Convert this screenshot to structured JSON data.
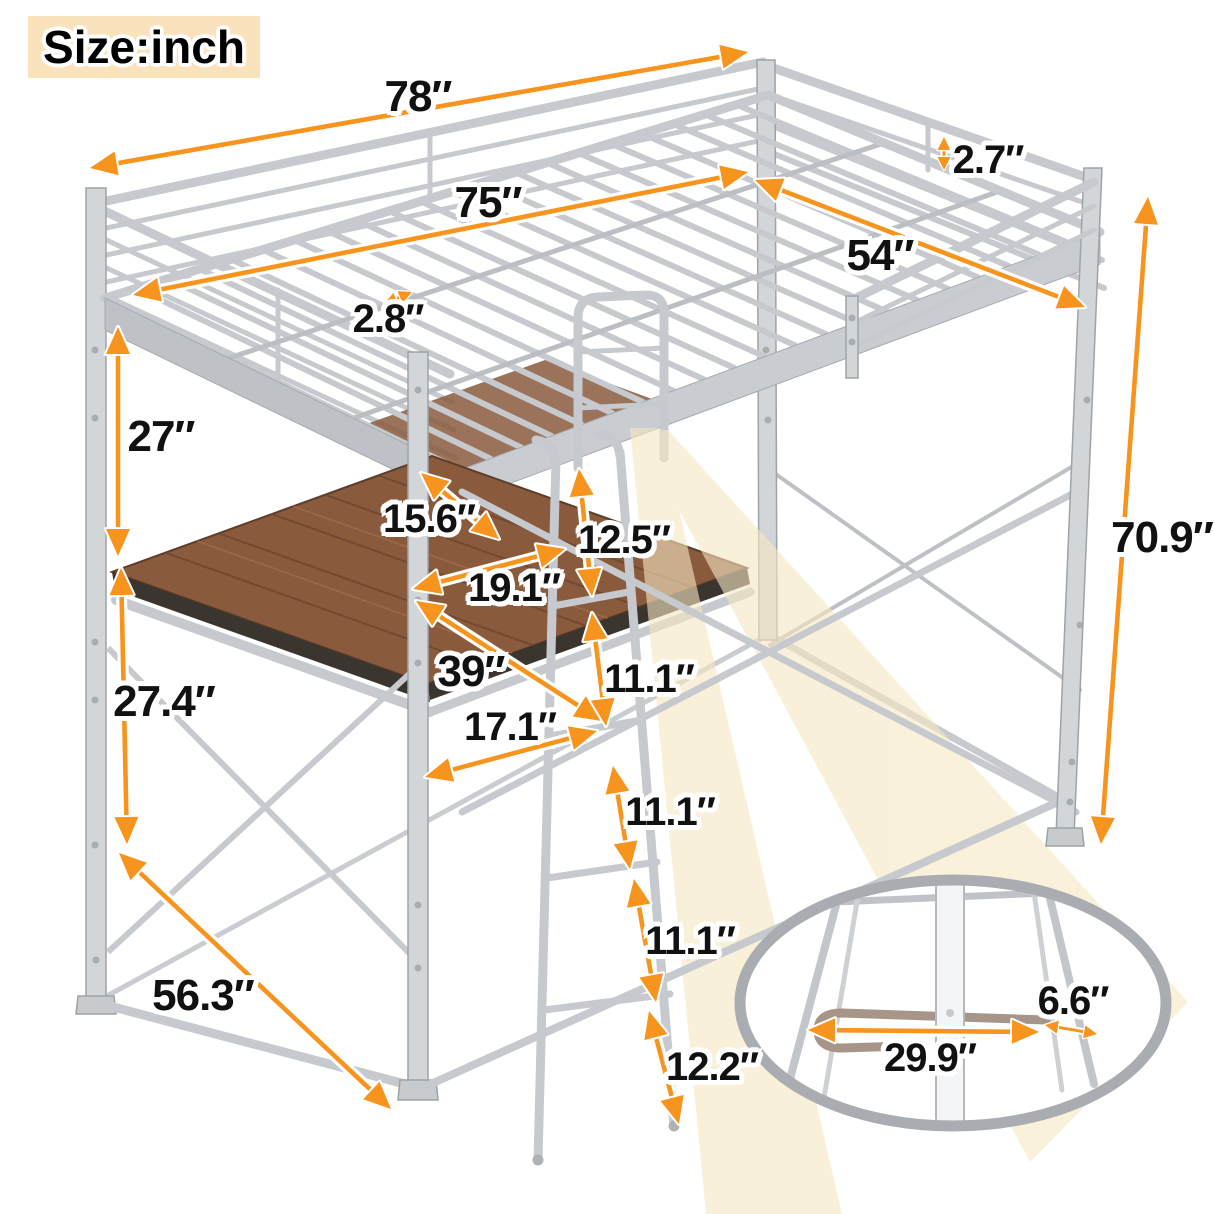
{
  "badge": {
    "label": "Size:inch"
  },
  "dims": {
    "length_overall": "78″",
    "length_inner": "75″",
    "rail_gap": "2.7″",
    "width_inner": "54″",
    "slat_gap": "2.8″",
    "clearance_upper": "27″",
    "desk_overhang": "15.6″",
    "ladder_step_top": "12.5″",
    "desk_depth_top": "19.1″",
    "desk_length": "39″",
    "ladder_step_2": "11.1″",
    "desk_depth_bottom": "17.1″",
    "ladder_step_3": "11.1″",
    "ladder_step_4": "11.1″",
    "ladder_step_bottom": "12.2″",
    "desk_clearance": "27.4″",
    "base_depth": "56.3″",
    "height_overall": "70.9″",
    "footrest_offset": "6.6″",
    "footrest_width": "29.9″"
  },
  "colors": {
    "arrow": "#F7941D",
    "beam": "#F6E7C2",
    "badge_bg": "#FAE2BC",
    "frame": "#C6CACE",
    "frame_dark": "#9EA3A7",
    "wood": "#8A5A3D",
    "text": "#111111"
  }
}
